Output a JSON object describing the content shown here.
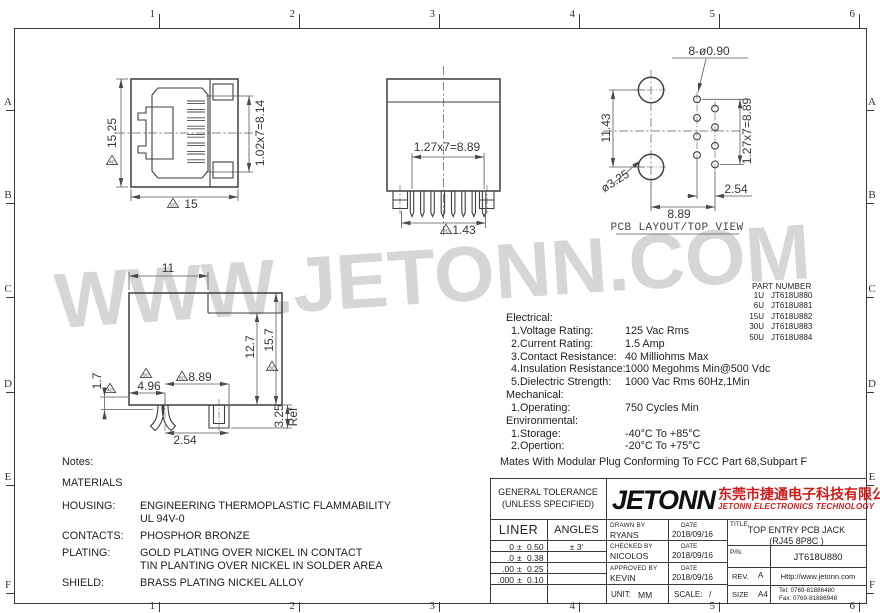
{
  "sheet": {
    "frame": {
      "cols": [
        "1",
        "2",
        "3",
        "4",
        "5",
        "6"
      ],
      "rows": [
        "A",
        "B",
        "C",
        "D",
        "E",
        "F"
      ]
    },
    "watermark": "WWW.JETONN.COM"
  },
  "drawing": {
    "view_caption": "PCB LAYOUT/TOP VIEW",
    "labels": [
      {
        "t": "15.25",
        "x": 112,
        "y": 133,
        "r": -90
      },
      {
        "t": "4C",
        "x": 112,
        "y": 160,
        "flag": true
      },
      {
        "t": "15",
        "x": 191,
        "y": 204
      },
      {
        "t": "2C",
        "x": 173,
        "y": 203,
        "flag": true
      },
      {
        "t": "1.02x7=8.14",
        "x": 260,
        "y": 133,
        "r": -90
      },
      {
        "t": "1.27x7=8.89",
        "x": 447,
        "y": 147
      },
      {
        "t": "1.43",
        "x": 464,
        "y": 230
      },
      {
        "t": "7C",
        "x": 446,
        "y": 229,
        "flag": true
      },
      {
        "t": "8-ø0.90",
        "x": 709,
        "y": 51
      },
      {
        "t": "11.43",
        "x": 606,
        "y": 128,
        "r": -90
      },
      {
        "t": "ø3.25",
        "x": 615,
        "y": 181,
        "r": -33
      },
      {
        "t": "1.27x7=8.89",
        "x": 747,
        "y": 131,
        "r": -90
      },
      {
        "t": "2.54",
        "x": 736,
        "y": 189
      },
      {
        "t": "8.89",
        "x": 679,
        "y": 214
      },
      {
        "t": "PCB LAYOUT/TOP VIEW",
        "x": 677,
        "y": 228,
        "mono": true
      },
      {
        "t": "11",
        "x": 168,
        "y": 268
      },
      {
        "t": "1.7",
        "x": 97,
        "y": 381,
        "r": -90
      },
      {
        "t": "4C",
        "x": 110,
        "y": 388,
        "flag": true
      },
      {
        "t": "4.96",
        "x": 149,
        "y": 386
      },
      {
        "t": "5C",
        "x": 146,
        "y": 373,
        "flag": true
      },
      {
        "t": "8.89",
        "x": 200,
        "y": 377
      },
      {
        "t": "6C",
        "x": 182,
        "y": 376,
        "flag": true
      },
      {
        "t": "12.7",
        "x": 250,
        "y": 347,
        "r": -90
      },
      {
        "t": "15.7",
        "x": 269,
        "y": 340,
        "r": -90
      },
      {
        "t": "3C",
        "x": 272,
        "y": 366,
        "flag": true
      },
      {
        "t": "2.54",
        "x": 185,
        "y": 440
      },
      {
        "t": "3.25",
        "x": 279,
        "y": 416,
        "r": -90
      },
      {
        "t": "Ref",
        "x": 293,
        "y": 417,
        "r": -90
      }
    ]
  },
  "specs": {
    "sections": [
      {
        "heading": "Electrical:",
        "items": [
          {
            "label": "1.Voltage Rating:",
            "value": "125 Vac Rms"
          },
          {
            "label": "2.Current Rating:",
            "value": "1.5 Amp"
          },
          {
            "label": "3.Contact Resistance:",
            "value": "40 Milliohms Max"
          },
          {
            "label": "4.Insulation Resistance:",
            "value": "1000 Megohms Min@500 Vdc"
          },
          {
            "label": "5.Dielectric Strength:",
            "value": "1000 Vac Rms 60Hz,1Min"
          }
        ]
      },
      {
        "heading": "Mechanical:",
        "items": [
          {
            "label": "1.Operating:",
            "value": "750 Cycles Min"
          }
        ]
      },
      {
        "heading": "Environmental:",
        "items": [
          {
            "label": "1.Storage:",
            "value": "-40°C To +85°C"
          },
          {
            "label": "2.Opertion:",
            "value": "-20°C To +75°C"
          }
        ]
      }
    ],
    "footnote": "Mates With Modular Plug Conforming To FCC Part 68,Subpart F"
  },
  "part_numbers": {
    "heading": "PART NUMBER",
    "rows": [
      [
        "1U",
        "JT618U880"
      ],
      [
        "6U",
        "JT618U881"
      ],
      [
        "15U",
        "JT618U882"
      ],
      [
        "30U",
        "JT618U883"
      ],
      [
        "50U",
        "JT618U884"
      ]
    ]
  },
  "notes": {
    "heading": "Notes:",
    "subheading": "MATERIALS",
    "rows": [
      {
        "label": "HOUSING:",
        "lines": [
          "ENGINEERING THERMOPLASTIC FLAMMABILITY",
          "UL 94V-0"
        ]
      },
      {
        "label": "CONTACTS:",
        "lines": [
          "PHOSPHOR BRONZE"
        ]
      },
      {
        "label": "PLATING:",
        "lines": [
          "GOLD PLATING OVER NICKEL IN CONTACT",
          "TIN PLANTING OVER NICKEL IN SOLDER AREA"
        ]
      },
      {
        "label": "SHIELD:",
        "lines": [
          "BRASS PLATING NICKEL ALLOY"
        ]
      }
    ]
  },
  "title_block": {
    "tolerance": {
      "title1": "GENERAL TOLERANCE",
      "title2": "(UNLESS SPECIFIED)",
      "col1": "LINER",
      "col2": "ANGLES",
      "rows": [
        [
          "0",
          "±",
          "0.50",
          "± 3'"
        ],
        [
          ".0",
          "±",
          "0.38",
          ""
        ],
        [
          ".00",
          "±",
          "0.25",
          ""
        ],
        [
          ".000",
          "±",
          "0.10",
          ""
        ]
      ]
    },
    "brand": {
      "logo": "JETONN",
      "company_cn": "东莞市捷通电子科技有限公司",
      "company_en": "JETONN ELECTRONICS TECHNOLOGY",
      "accent_color": "#ce1c1c"
    },
    "signoff": [
      {
        "role": "DRAWN BY",
        "name": "RYANS",
        "date_label": "DATE",
        "date": "2018/09/16"
      },
      {
        "role": "CHECKED BY",
        "name": "NICOLOS",
        "date_label": "DATE",
        "date": "2018/09/16"
      },
      {
        "role": "APPROVED BY",
        "name": "KEVIN",
        "date_label": "DATE",
        "date": "2018/09/16"
      }
    ],
    "unit_label": "UNIT:",
    "unit": "MM",
    "scale_label": "SCALE:",
    "scale": "/",
    "title_label": "TITLE.",
    "title_line1": "TOP ENTRY PCB JACK",
    "title_line2": "(RJ45 8P8C )",
    "pn_label": "P/N.",
    "pn": "JT618U880",
    "rev_label": "REV.",
    "rev": "A",
    "size_label": "SIZE",
    "size": "A4",
    "website": "Http://www.jetonn.com",
    "tel": "Tel:  0769-81886480",
    "fax": "Fax: 0769-81886948"
  }
}
